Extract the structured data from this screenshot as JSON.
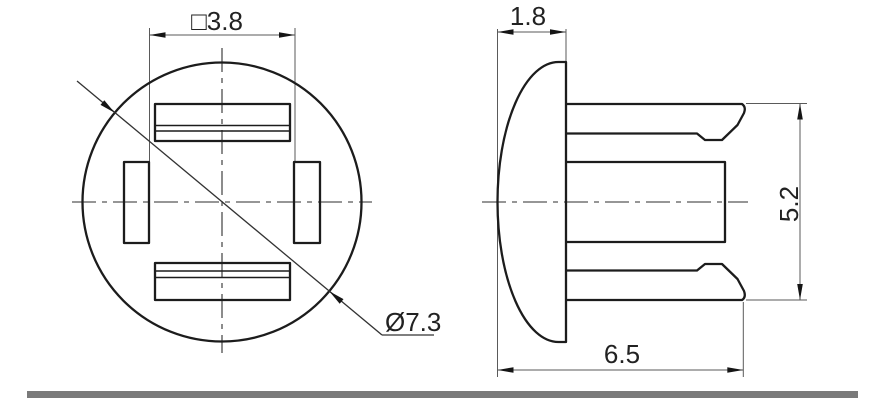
{
  "drawing": {
    "front_view": {
      "square_dim_label": "□3.8",
      "diameter_label": "Ø7.3"
    },
    "side_view": {
      "cap_thickness_label": "1.8",
      "grip_height_label": "5.2",
      "length_label": "6.5"
    },
    "colors": {
      "line": "#1c1c1c",
      "thin_line": "#5a5a5a",
      "background": "#ffffff",
      "divider": "#7a7a7a"
    }
  }
}
